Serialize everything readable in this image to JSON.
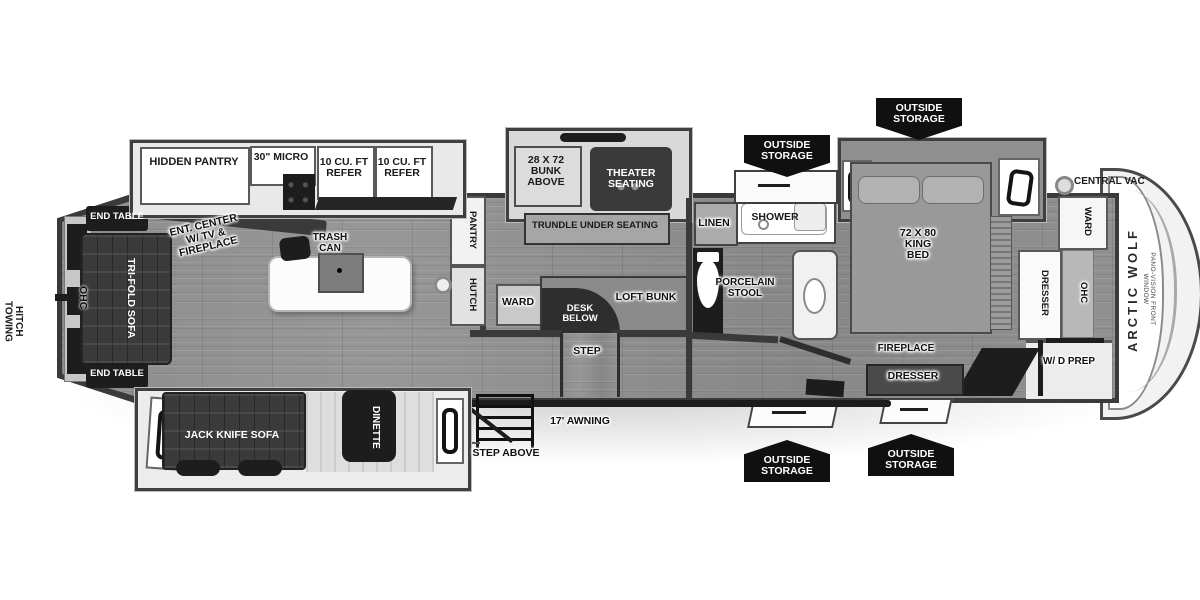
{
  "diagram": {
    "type": "rv-floorplan",
    "model": "Arctic Wolf fifth wheel"
  },
  "exterior": {
    "towing_hitch": "TOWING\nHITCH",
    "central_vac": "CENTRAL VAC",
    "awning": "17' AWNING",
    "step_above": "STEP ABOVE",
    "outside_storage_top_left": "OUTSIDE\nSTORAGE",
    "outside_storage_top_right": "OUTSIDE\nSTORAGE",
    "outside_storage_bottom_left": "OUTSIDE\nSTORAGE",
    "outside_storage_bottom_right": "OUTSIDE\nSTORAGE",
    "brand": "ARCTIC WOLF",
    "front_window": "PANO-VISION FRONT WINDOW"
  },
  "living": {
    "ohc": "OHC",
    "end_table_top": "END TABLE",
    "end_table_bottom": "END TABLE",
    "tri_fold_sofa": "TRI-FOLD SOFA",
    "ent_center": "ENT. CENTER\nW/ TV &\nFIREPLACE",
    "trash_can": "TRASH\nCAN"
  },
  "kitchen": {
    "hidden_pantry": "HIDDEN PANTRY",
    "micro": "30\" MICRO",
    "refer_left": "10 CU. FT\nREFER",
    "refer_right": "10 CU. FT\nREFER",
    "pantry": "PANTRY",
    "hutch": "HUTCH"
  },
  "bunk": {
    "bunk_above": "28 X 72\nBUNK\nABOVE",
    "theater_seating": "THEATER\nSEATING",
    "trundle": "TRUNDLE UNDER SEATING",
    "ward": "WARD",
    "desk_below": "DESK\nBELOW",
    "loft_bunk": "LOFT BUNK",
    "step": "STEP"
  },
  "bath": {
    "linen": "LINEN",
    "shower": "SHOWER",
    "porcelain_stool": "PORCELAIN\nSTOOL"
  },
  "bedroom": {
    "king_bed": "72 X 80\nKING\nBED",
    "ward": "WARD",
    "dresser_side": "DRESSER",
    "ohc": "OHC",
    "fireplace": "FIREPLACE",
    "dresser_bottom": "DRESSER",
    "wd_prep": "W/ D PREP"
  },
  "dinette_slide": {
    "jack_knife_sofa": "JACK KNIFE SOFA",
    "dinette": "DINETTE"
  }
}
